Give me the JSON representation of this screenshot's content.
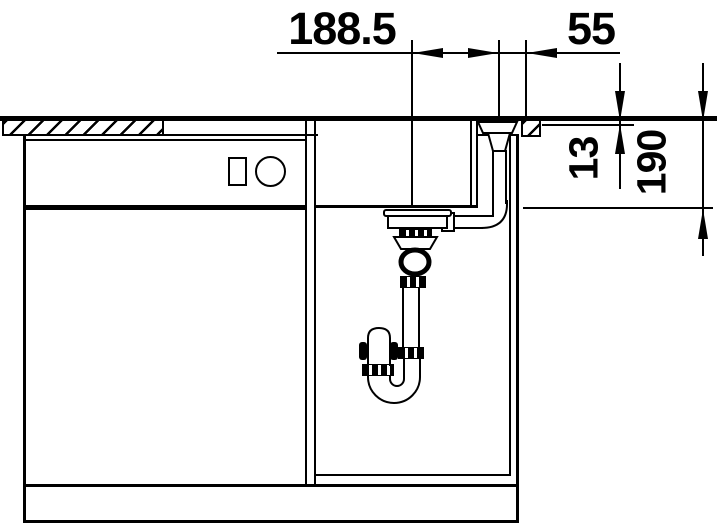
{
  "drawing": {
    "type": "sink-installation-section",
    "colors": {
      "line": "#000000",
      "background": "#ffffff"
    },
    "dimensions": {
      "drain_to_knob": "188.5",
      "knob_to_edge": "55",
      "rim_offset": "13",
      "bowl_depth": "190"
    }
  }
}
